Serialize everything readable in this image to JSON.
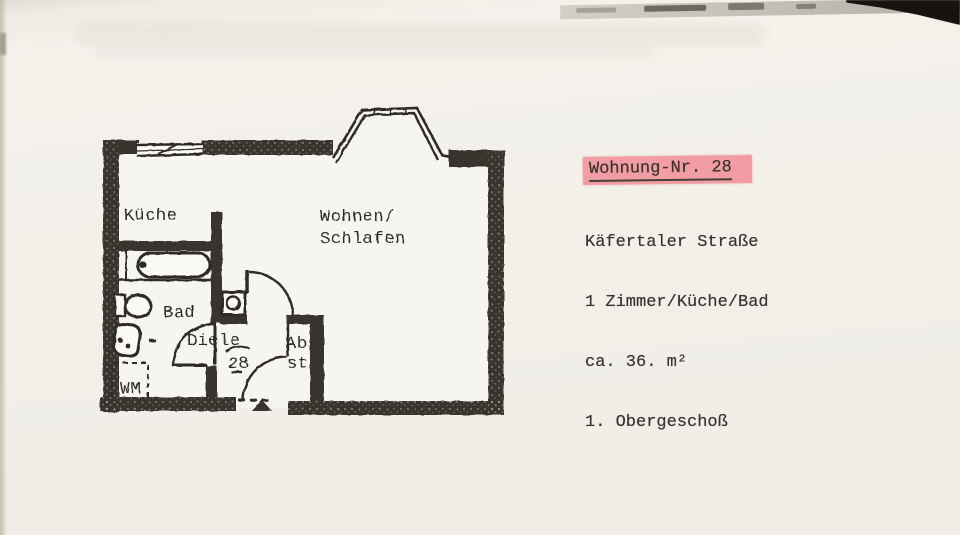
{
  "page": {
    "paper_color": "#f2f0e9",
    "ink_color": "#2c2a26",
    "wall_color": "#37342e"
  },
  "floor_plan": {
    "labels": {
      "kitchen": "Küche",
      "living_line1": "Wohnen/",
      "living_line2": "Schlafen",
      "bath": "Bad",
      "hallway": "Diele",
      "hallway_number": "28",
      "storage_line1": "Ab-",
      "storage_line2": "st.",
      "washing_machine": "WM"
    }
  },
  "info_block": {
    "title": "Wohnung-Nr. 28",
    "highlight_color": "#f19da3",
    "lines": [
      "Käfertaler Straße",
      "1 Zimmer/Küche/Bad",
      "ca. 36. m²",
      "1. Obergeschoß"
    ]
  }
}
